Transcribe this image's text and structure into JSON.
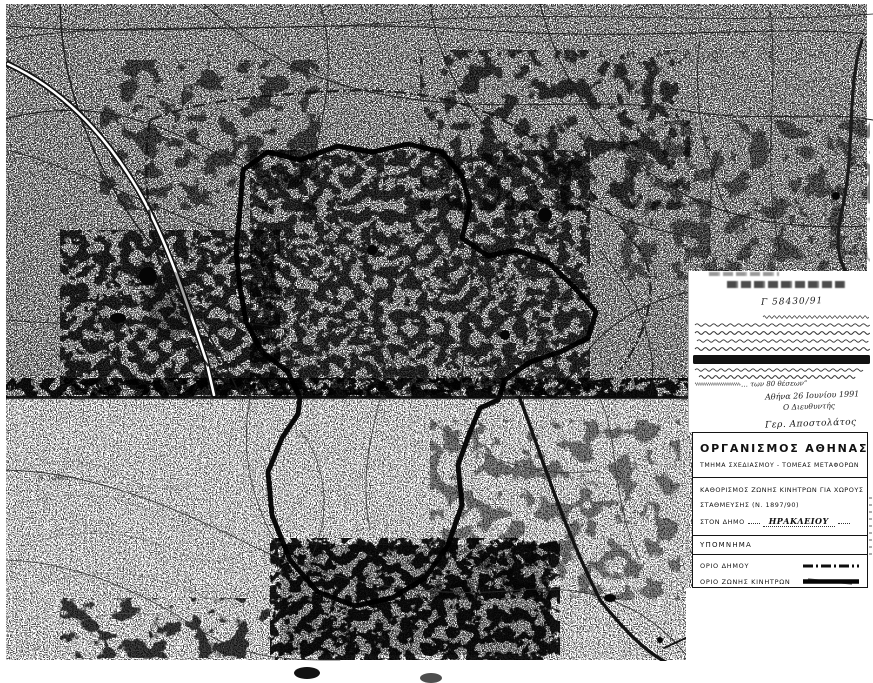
{
  "map": {
    "labels": {
      "district_top_right": "Α Μ Α Ρ Ο Υ Σ Ι",
      "district_left": "Ν. Ιωνία"
    }
  },
  "note": {
    "reference": "Γ 58430/91",
    "body_fragment": "… των 80 θέσεων”",
    "date": "Αθήνα 26 Ιουνίου 1991",
    "signoff": "Ο Διευθυντής",
    "signature": "Γερ. Αποστολάτος"
  },
  "legend": {
    "org": "ΟΡΓΑΝΙΣΜΟΣ ΑΘΗΝΑΣ",
    "dept": "ΤΜΗΜΑ ΣΧΕΔΙΑΣΜΟΥ - ΤΟΜΕΑΣ ΜΕΤΑΦΟΡΩΝ",
    "project_line1": "ΚΑΘΟΡΙΣΜΟΣ ΖΩΝΗΣ ΚΙΝΗΤΡΩΝ ΓΙΑ ΧΩΡΟΥΣ",
    "project_line2": "ΣΤΑΘΜΕΥΣΗΣ (Ν. 1897/90)",
    "municipality_label": "ΣΤΟΝ ΔΗΜΟ",
    "municipality": "ΗΡΑΚΛΕΙΟΥ",
    "heading": "ΥΠΟΜΝΗΜΑ",
    "items": [
      {
        "label": "ΟΡΙΟ ΔΗΜΟΥ",
        "style": "dash-dot"
      },
      {
        "label": "ΟΡΙΟ ΖΩΝΗΣ ΚΙΝΗΤΡΩΝ",
        "style": "solid-thick"
      }
    ]
  },
  "colors": {
    "ink": "#111111",
    "paper": "#ffffff"
  }
}
